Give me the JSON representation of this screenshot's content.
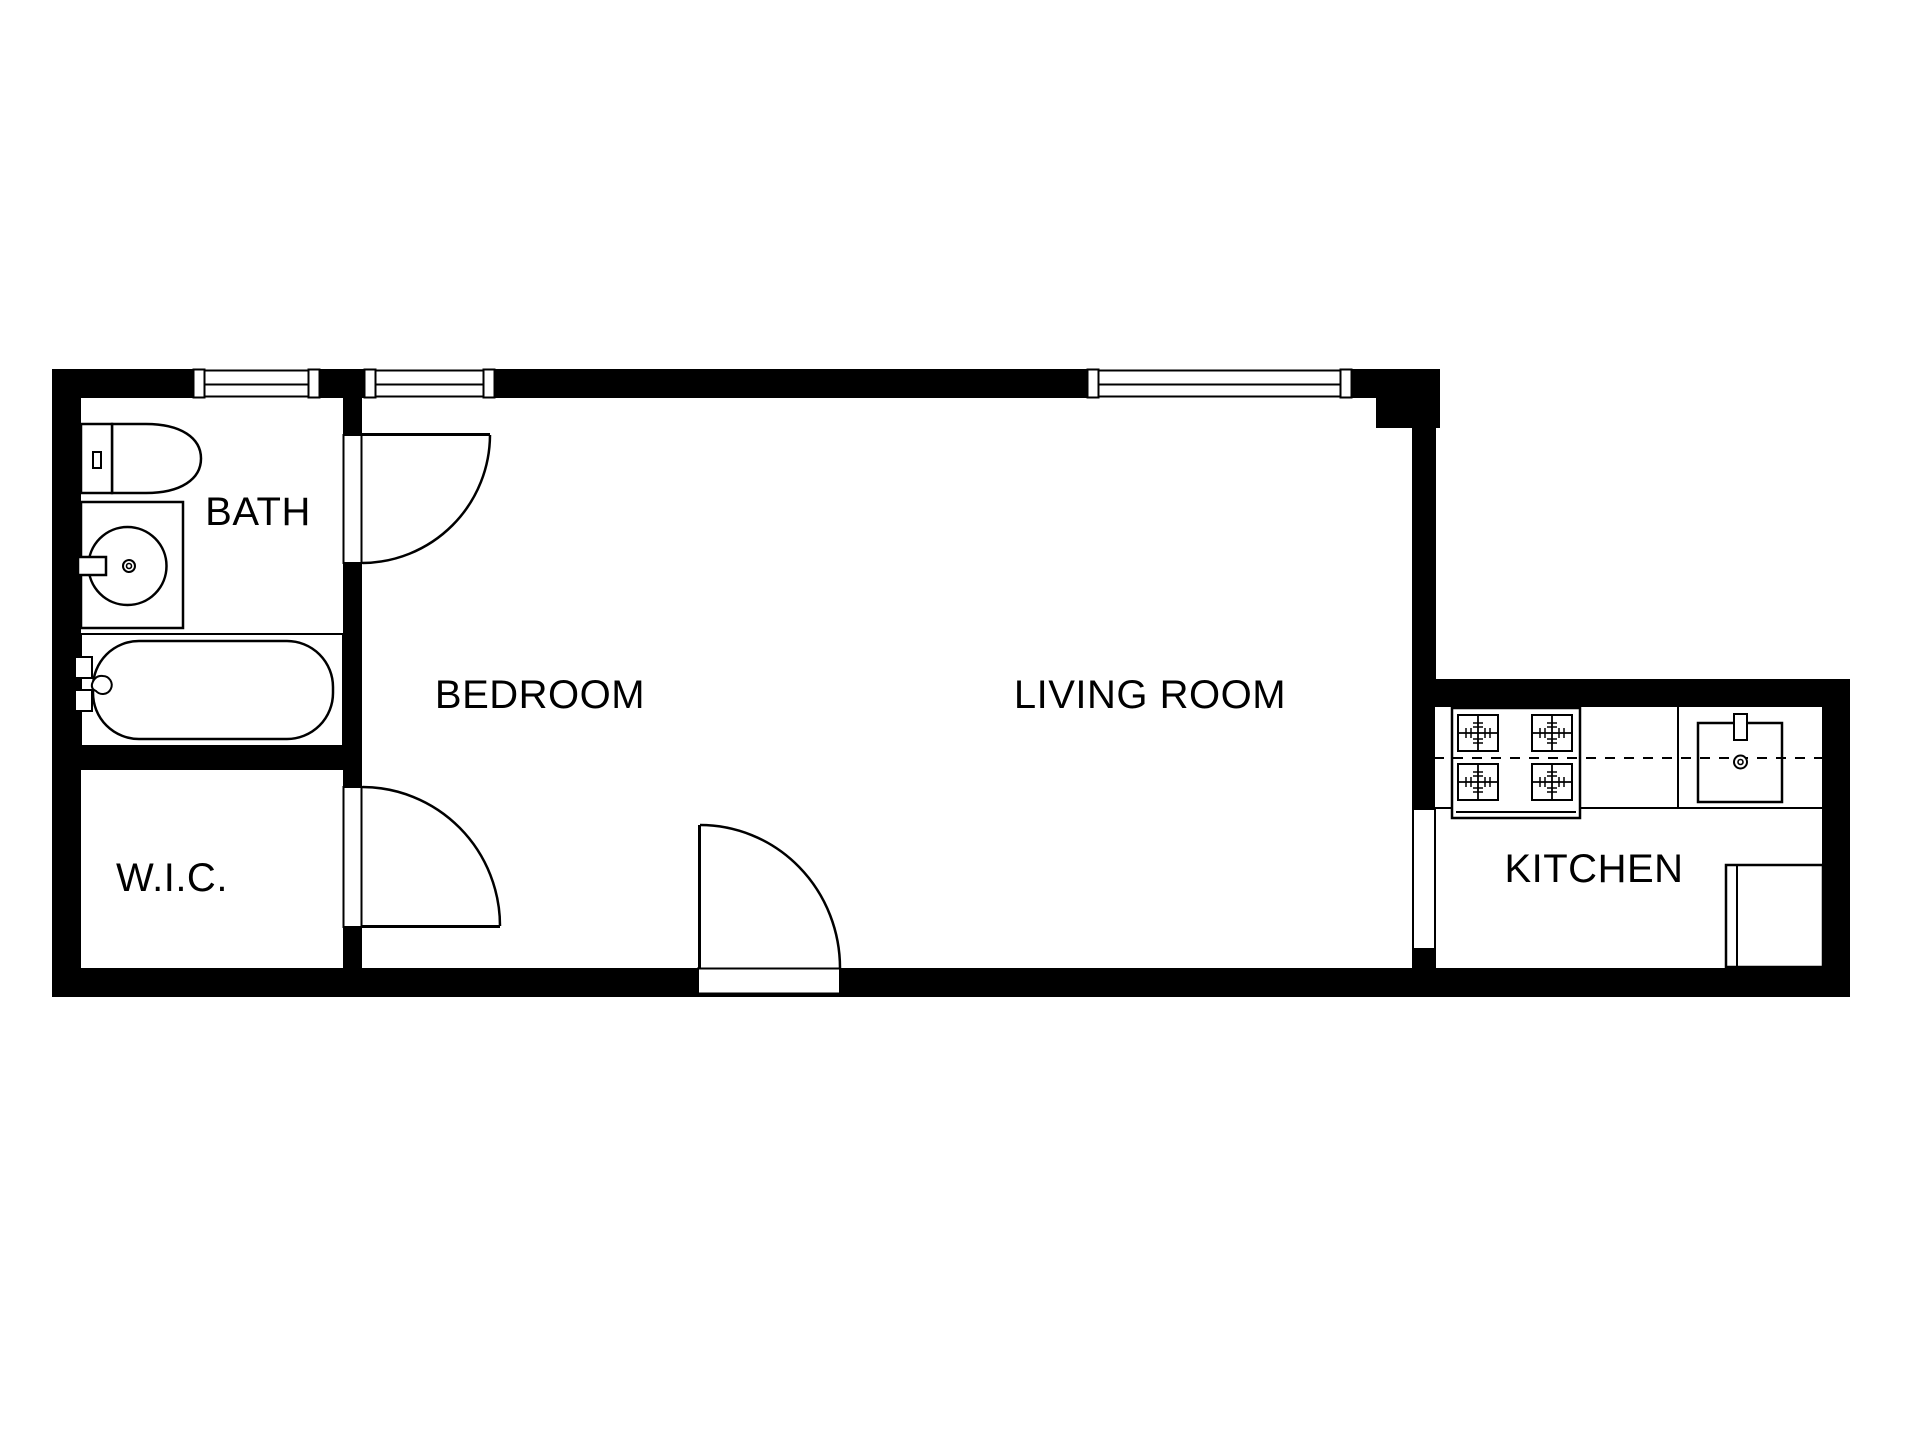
{
  "colors": {
    "background": "#ffffff",
    "walls": "#000000",
    "lines": "#000000",
    "text": "#000000"
  },
  "rooms": {
    "bath": {
      "label": "BATH"
    },
    "wic": {
      "label": "W.I.C."
    },
    "bedroom": {
      "label": "BEDROOM"
    },
    "living_room": {
      "label": "LIVING ROOM"
    },
    "kitchen": {
      "label": "KITCHEN"
    }
  },
  "fixtures": {
    "bath": [
      "toilet",
      "vanity-sink",
      "bathtub"
    ],
    "kitchen": [
      "four-burner-stove",
      "kitchen-sink",
      "refrigerator"
    ],
    "doors": [
      "bath-door",
      "wic-door",
      "entry-door"
    ],
    "windows": [
      "bath-window",
      "bedroom-window",
      "living-room-window"
    ],
    "passages": [
      "kitchen-passage"
    ]
  }
}
